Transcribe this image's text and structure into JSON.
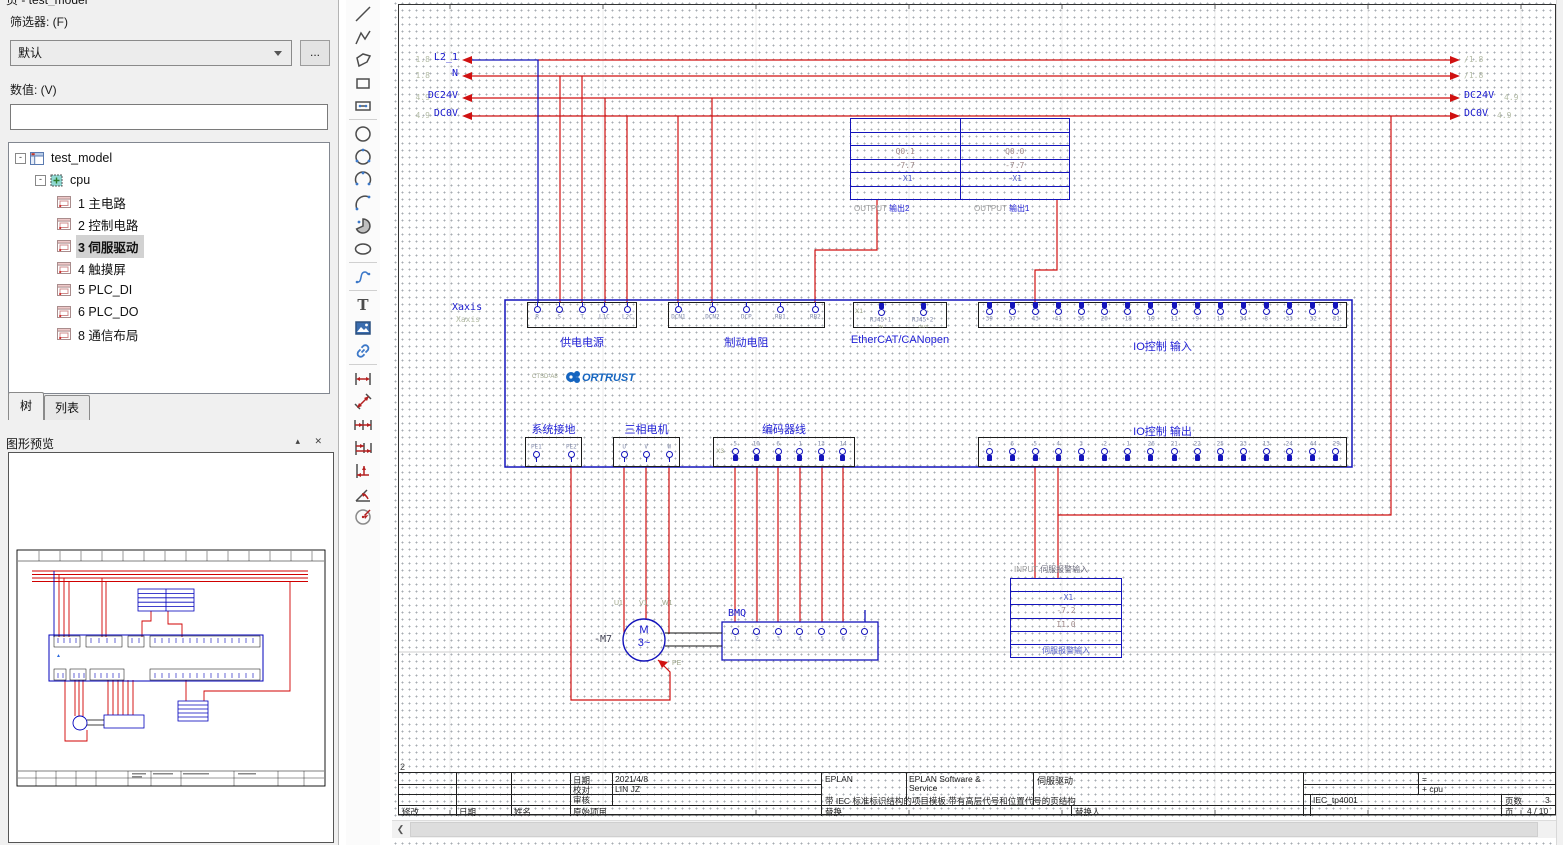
{
  "panel": {
    "title": "页 - test_model",
    "filter_label": "筛选器: (F)",
    "filter_value": "默认",
    "more_button": "...",
    "value_label": "数值: (V)",
    "value_input": "",
    "tree": {
      "root": "test_model",
      "node": "cpu",
      "pages": [
        "1 主电路",
        "2 控制电路",
        "3 伺服驱动",
        "4 触摸屏",
        "5 PLC_DI",
        "6 PLC_DO",
        "8 通信布局"
      ],
      "selected": "3 伺服驱动"
    },
    "tabs": {
      "tree": "树",
      "list": "列表"
    },
    "preview_title": "图形预览",
    "preview_buttons": "▴ ✕"
  },
  "toolbar": {
    "groups": [
      [
        "line",
        "polyline",
        "polygon",
        "rectangle",
        "rounded-rectangle"
      ],
      [
        "circle",
        "circle-3-point",
        "arc-3-point",
        "arc",
        "sector",
        "ellipse"
      ],
      [
        "spline"
      ],
      [
        "text",
        "image",
        "hyperlink"
      ],
      [
        "dimension-linear",
        "dimension-aligned",
        "dimension-chain",
        "dimension-baseline",
        "dimension-offset",
        "dimension-angle",
        "dimension-radius"
      ]
    ]
  },
  "schematic": {
    "potentials": [
      {
        "name": "L2_1",
        "ref_left": "1.8",
        "ref_right": "/1.8"
      },
      {
        "name": "N",
        "ref_left": "1.8",
        "ref_right": "/1.8"
      },
      {
        "name": "DC24V",
        "ref_left": "4.9",
        "ref_right": "4.9"
      },
      {
        "name": "DC0V",
        "ref_left": "4.9",
        "ref_right": "4.9"
      }
    ],
    "plc_output_block": {
      "columns": [
        {
          "address": "Q0.1",
          "device": "-7.7",
          "terminal": "-X1",
          "label_type": "OUTPUT",
          "label_name": "输出2"
        },
        {
          "address": "Q0.0",
          "device": "-7.7",
          "terminal": "-X1",
          "label_type": "OUTPUT",
          "label_name": "输出1"
        }
      ]
    },
    "drive": {
      "axis_label": "Xaxis",
      "axis_sub": "Xaxis",
      "model": "CTSD-A8",
      "brand": "ORTRUST",
      "connectors_top": [
        {
          "title": "供电电源",
          "terminals": [
            "R",
            "S",
            "T",
            "L1C",
            "L2C"
          ]
        },
        {
          "title": "制动电阻",
          "terminals": [
            "DCN1",
            "DCN2",
            "DCP",
            "RB1",
            "RB2"
          ]
        },
        {
          "title": "EtherCAT/CANopen",
          "designator": "X1",
          "plugs": [
            "RJ45-1",
            "RJ45-2"
          ],
          "subs": [
            "IN",
            "OUT"
          ]
        },
        {
          "title": "IO控制 输入",
          "terminals": [
            "39",
            "37",
            "43",
            "41",
            "35",
            "20",
            "18",
            "19",
            "11",
            "9",
            "10",
            "34",
            "8",
            "33",
            "32",
            "31"
          ]
        }
      ],
      "connectors_bottom": [
        {
          "title": "系统接地",
          "terminals": [
            "PE1",
            "PE2"
          ]
        },
        {
          "title": "三相电机",
          "terminals": [
            "U",
            "V",
            "W"
          ]
        },
        {
          "title": "编码器线",
          "designator": "X3",
          "terminals": [
            "5",
            "10",
            "6",
            "1",
            "13",
            "14"
          ]
        },
        {
          "title": "IO控制 输出",
          "terminals": [
            "7",
            "6",
            "5",
            "4",
            "3",
            "2",
            "1",
            "26",
            "21",
            "22",
            "25",
            "23",
            "13",
            "24",
            "44",
            "29"
          ]
        }
      ]
    },
    "motor": {
      "tag": "-M7",
      "letter": "M",
      "phase": "3~",
      "pe": "PE",
      "wires": [
        "U1",
        "V1",
        "W1"
      ]
    },
    "encoder": {
      "tag": "BMQ",
      "terminals": [
        "1",
        "2",
        "3",
        "4",
        "5",
        "6",
        "7"
      ]
    },
    "plc_input_block": {
      "header_type": "INPUT",
      "header_name": "伺服报警输入",
      "rows": [
        "-X1",
        "-7.2",
        "I1.0",
        "伺服报警输入"
      ]
    },
    "grid_col_label": "2"
  },
  "titleblock": {
    "date_label": "日期",
    "date_value": "2021/4/8",
    "checked_label": "校对",
    "checked_value": "LIN JZ",
    "approved_label": "审核",
    "approved_value": "",
    "modified_label": "修改",
    "date2_label": "日期",
    "name_label": "姓名",
    "orig_label": "原始项目",
    "brand": "EPLAN",
    "project_desc": "带 IEC 标准标识结构的项目模板:带有高层代号和位置代号的页结构",
    "company_line1": "EPLAN Software &",
    "company_line2": "Service",
    "page_desc": "伺服驱动",
    "replace_label": "替换",
    "replace_by_label": "替换人",
    "eq_label": "=",
    "plus_label": "+ cpu",
    "form_name": "IEC_tp4001",
    "pages_label": "页数",
    "pages_value": "3",
    "page_label": "页",
    "page_value": "4 / 10"
  }
}
